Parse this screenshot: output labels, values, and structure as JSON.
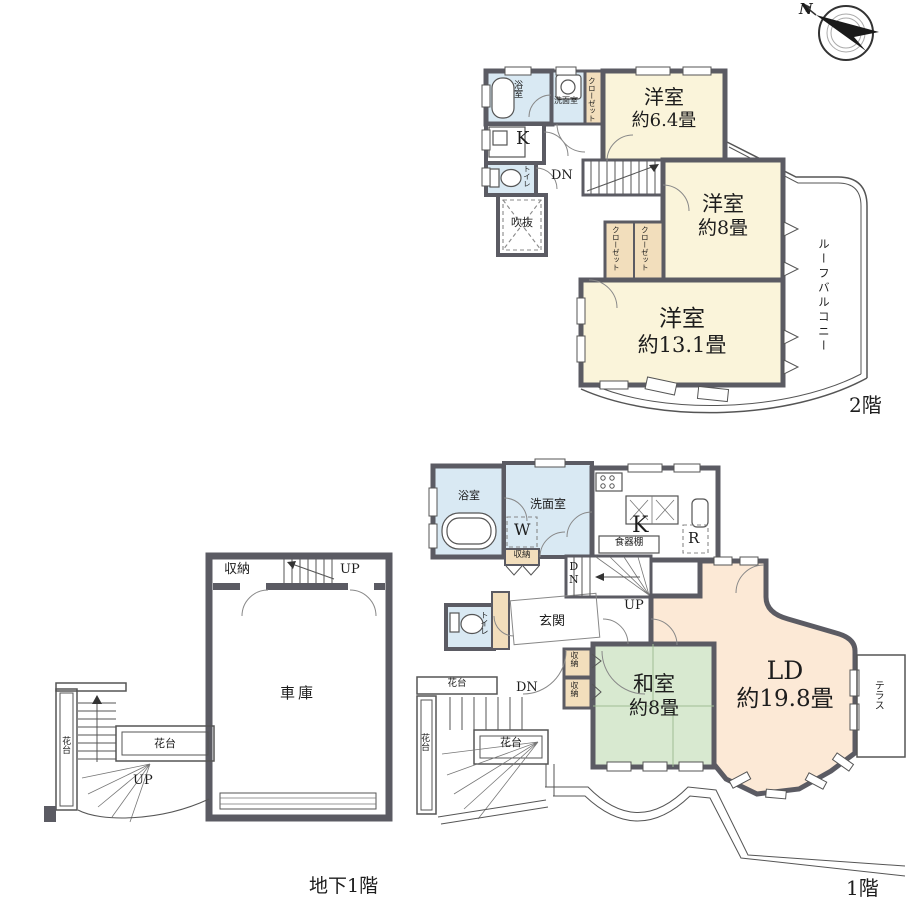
{
  "colors": {
    "wall": "#5b5b63",
    "western_room": "#faf4da",
    "living_room": "#fce9d6",
    "wet_area": "#d9e9f3",
    "tatami_room": "#d8e9d0",
    "closet": "#f2debc"
  },
  "compass": {
    "north_label": "N"
  },
  "floor2": {
    "title": "2階",
    "bath": "浴室",
    "washroom": "洗面室",
    "closet_a": "クローゼット",
    "closet_b": "クローゼット",
    "closet_c": "クローゼット",
    "kitchen": "K",
    "toilet": "トイレ",
    "stairs_dn": "DN",
    "void": "吹抜",
    "bedroom1_name": "洋室",
    "bedroom1_size": "約6.4畳",
    "bedroom2_name": "洋室",
    "bedroom2_size": "約8畳",
    "bedroom3_name": "洋室",
    "bedroom3_size": "約13.1畳",
    "roof_balcony": "ルーフバルコニー"
  },
  "floor1": {
    "title": "1階",
    "bath": "浴室",
    "washroom": "洗面室",
    "washer": "W",
    "storage_small": "収納",
    "kitchen": "K",
    "cupboard": "食器棚",
    "fridge": "R",
    "stairs_dn": "DN",
    "stairs_up": "UP",
    "toilet": "トイレ",
    "entrance": "玄関",
    "storage_a": "収納",
    "storage_b": "収納",
    "japanese_room_name": "和室",
    "japanese_room_size": "約8畳",
    "living_name": "LD",
    "living_size": "約19.8畳",
    "terrace": "テラス",
    "flower_top": "花台",
    "flower_left": "花台",
    "flower_mid": "花台",
    "outdoor_dn": "DN"
  },
  "basement": {
    "title": "地下1階",
    "storage": "収納",
    "stairs_up": "UP",
    "garage": "車庫",
    "flower_left": "花台",
    "flower_box": "花台",
    "outdoor_up": "UP"
  }
}
